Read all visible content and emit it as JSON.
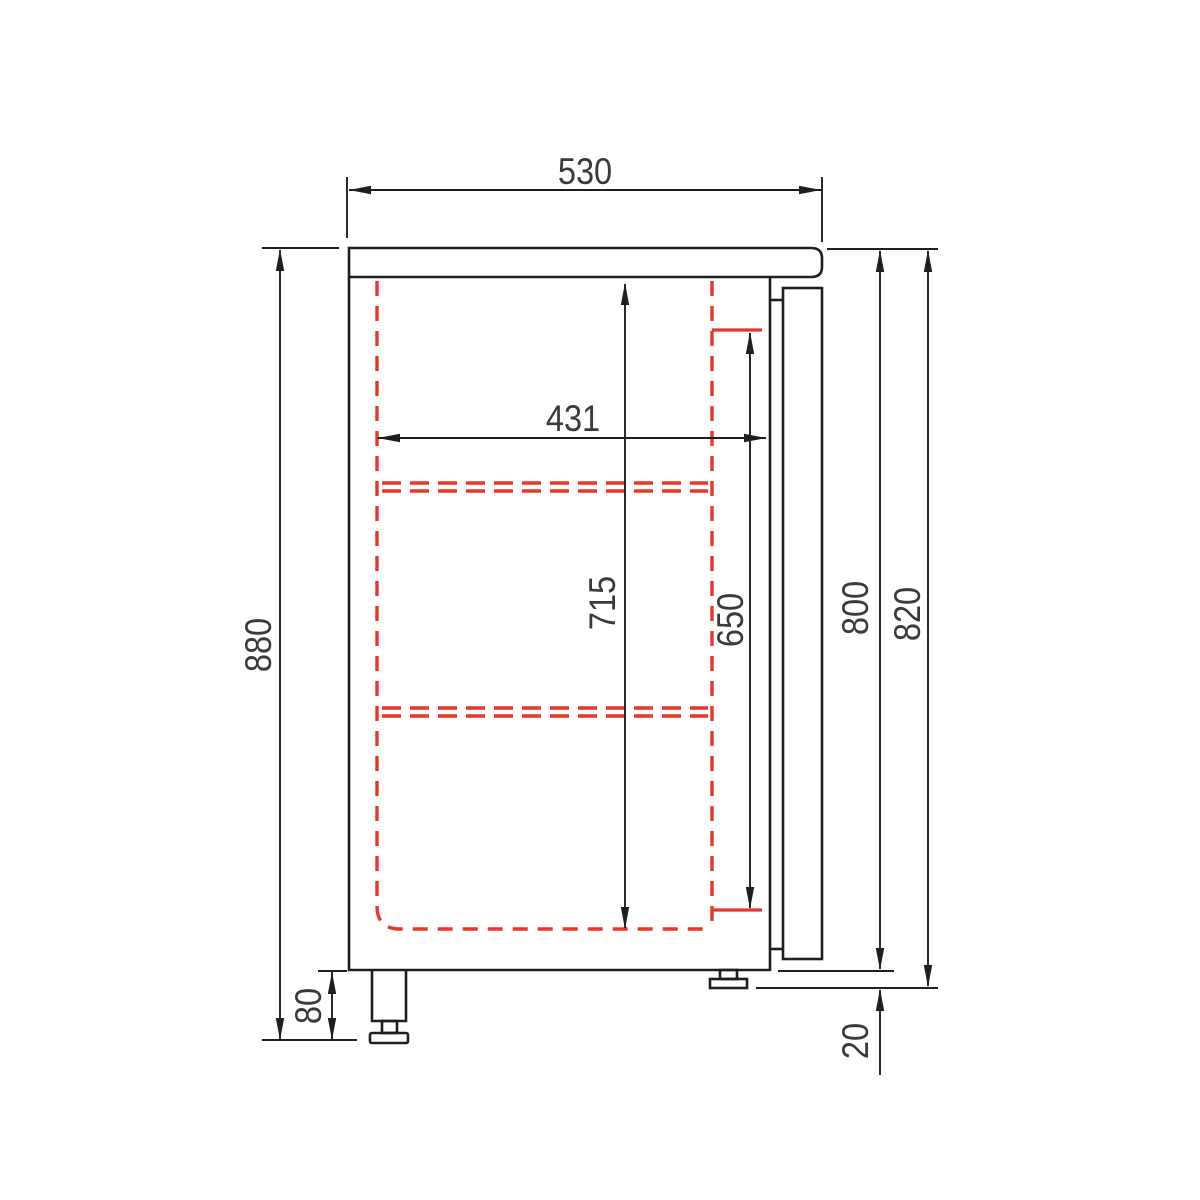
{
  "drawing": {
    "title": "refrigerated-counter-side-section",
    "units": "mm"
  },
  "dims": {
    "d530": "530",
    "d431": "431",
    "d880": "880",
    "d715": "715",
    "d650": "650",
    "d800": "800",
    "d820": "820",
    "d80": "80",
    "d20": "20"
  },
  "colors": {
    "line": "#1f1f1f",
    "red": "#e8362b",
    "text": "#3a3a3a",
    "background": "#ffffff"
  }
}
